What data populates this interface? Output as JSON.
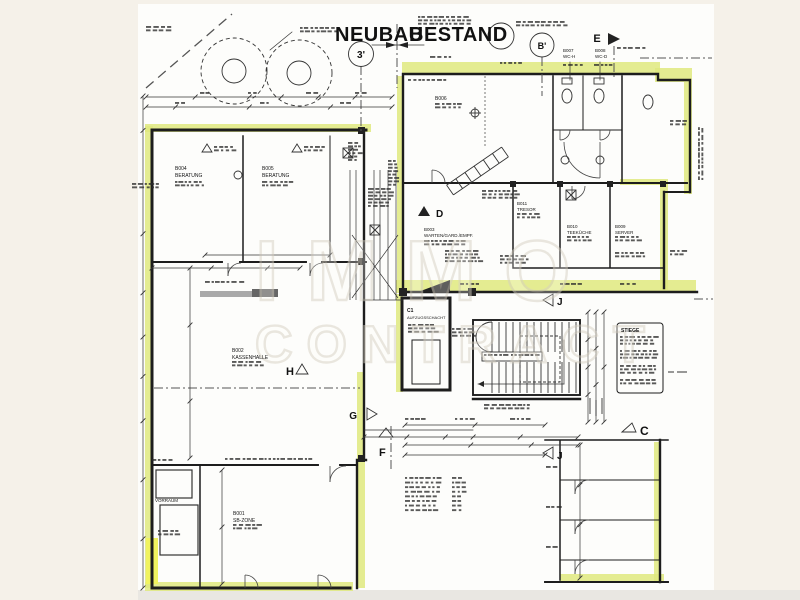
{
  "title": {
    "left": "NEUBAU",
    "right": "BESTAND"
  },
  "watermark": {
    "line1": "IMMO",
    "line2": "CONTRACT"
  },
  "markers": {
    "m3": "3'",
    "mB": "B'",
    "mE": "E",
    "mD": "D",
    "mJ1": "J",
    "mJ2": "J",
    "mC": "C",
    "mH": "H",
    "mG": "G",
    "mF": "F"
  },
  "rooms": {
    "b004": {
      "id": "B004",
      "name": "BERATUNG"
    },
    "b005": {
      "id": "B005",
      "name": "BERATUNG"
    },
    "b002": {
      "id": "B002",
      "name": "KASSENHALLE"
    },
    "b001": {
      "id": "B001",
      "name": "SB-ZONE"
    },
    "vorraum": {
      "name": "VORRAUM"
    },
    "b003": {
      "id": "B003",
      "name": "WARTEN/GARD./EMPF."
    },
    "b006": {
      "id": "B006"
    },
    "b007": {
      "id": "B007",
      "name": "WC-H"
    },
    "b008": {
      "id": "B008",
      "name": "WC-D"
    },
    "b011": {
      "id": "B011",
      "name": "TRESOR"
    },
    "b010": {
      "id": "B010",
      "name": "TEEKÜCHE"
    },
    "b009": {
      "id": "B009",
      "name": "SERVER"
    },
    "c1": {
      "id": "C1",
      "name": "AUFZUGSSCHACHT"
    }
  },
  "notes": {
    "stiege_title": "STIEGE"
  },
  "colors": {
    "wall_highlight": "#dfe97e",
    "bright_highlight": "#f1f35f",
    "ink": "#1d1d1d",
    "paper": "#fdfdfb",
    "margin": "#f5f1e9"
  }
}
